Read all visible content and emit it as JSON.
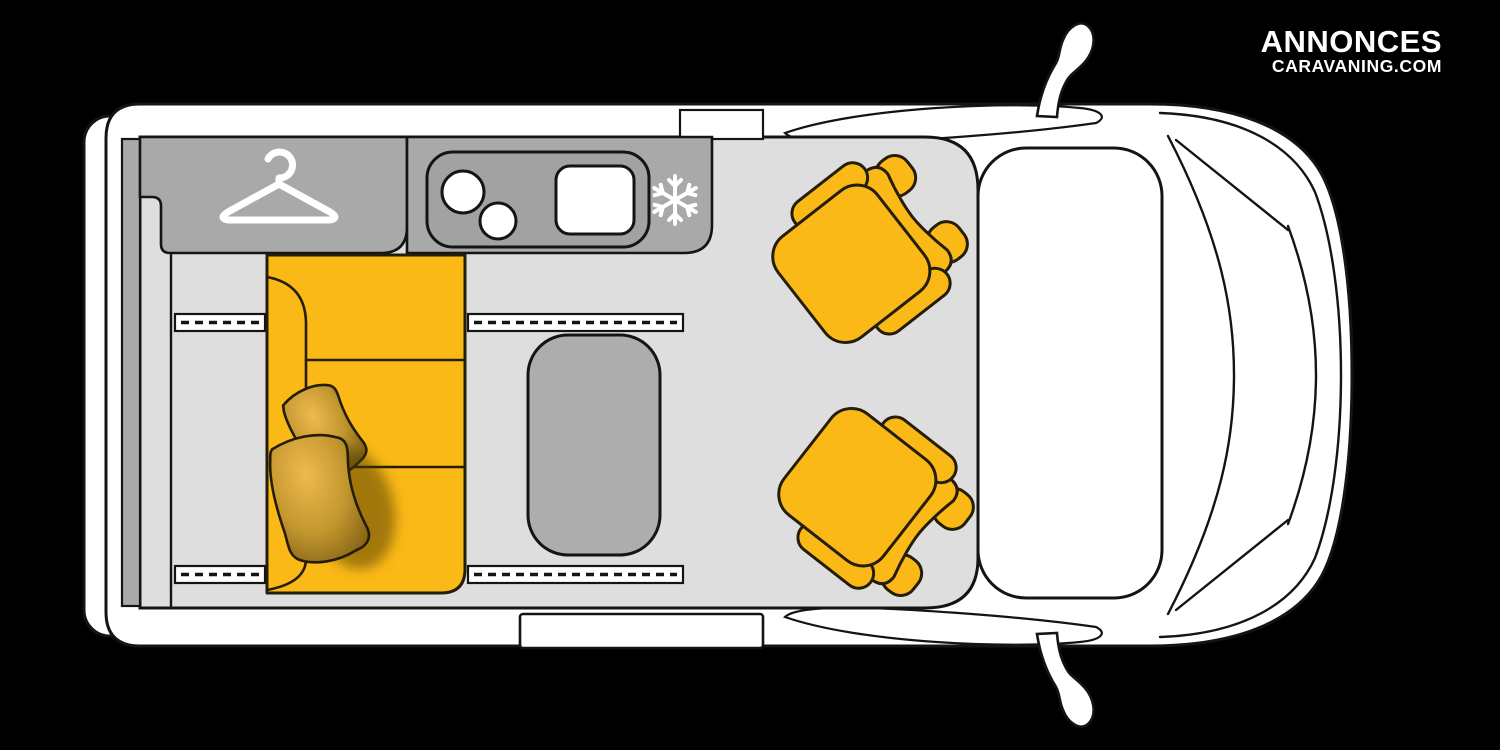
{
  "brand": {
    "line1": "ANNONCES",
    "line2": "CARAVANING.COM"
  },
  "diagram": {
    "type": "campervan-floorplan-top-view",
    "background": "#000000",
    "colors": {
      "body_white": "#ffffff",
      "outline": "#141414",
      "floor_gray": "#dedede",
      "cabinet_gray": "#a9a9a9",
      "counter_gray": "#a2a2a2",
      "table_gray": "#adadad",
      "upholstery_yellow": "#fbb918",
      "pillow_light": "#eeba4e",
      "pillow_mid": "#c2962e",
      "pillow_dark": "#7c5d12",
      "icon_white": "#ffffff"
    },
    "icons": {
      "hanger_icon": "wardrobe / closet",
      "snowflake_icon": "fridge-freezer"
    },
    "elements": {
      "rear_doors": 1,
      "side_mirrors": 2,
      "wardrobe": 1,
      "kitchen_counter": {
        "burners": 2,
        "sink": 1
      },
      "fridge": 1,
      "bed_sofa": {
        "cushion_sections": 3,
        "pillows": 2,
        "slide_rails": 4
      },
      "table": 1,
      "swivel_cab_seats": 2
    }
  }
}
